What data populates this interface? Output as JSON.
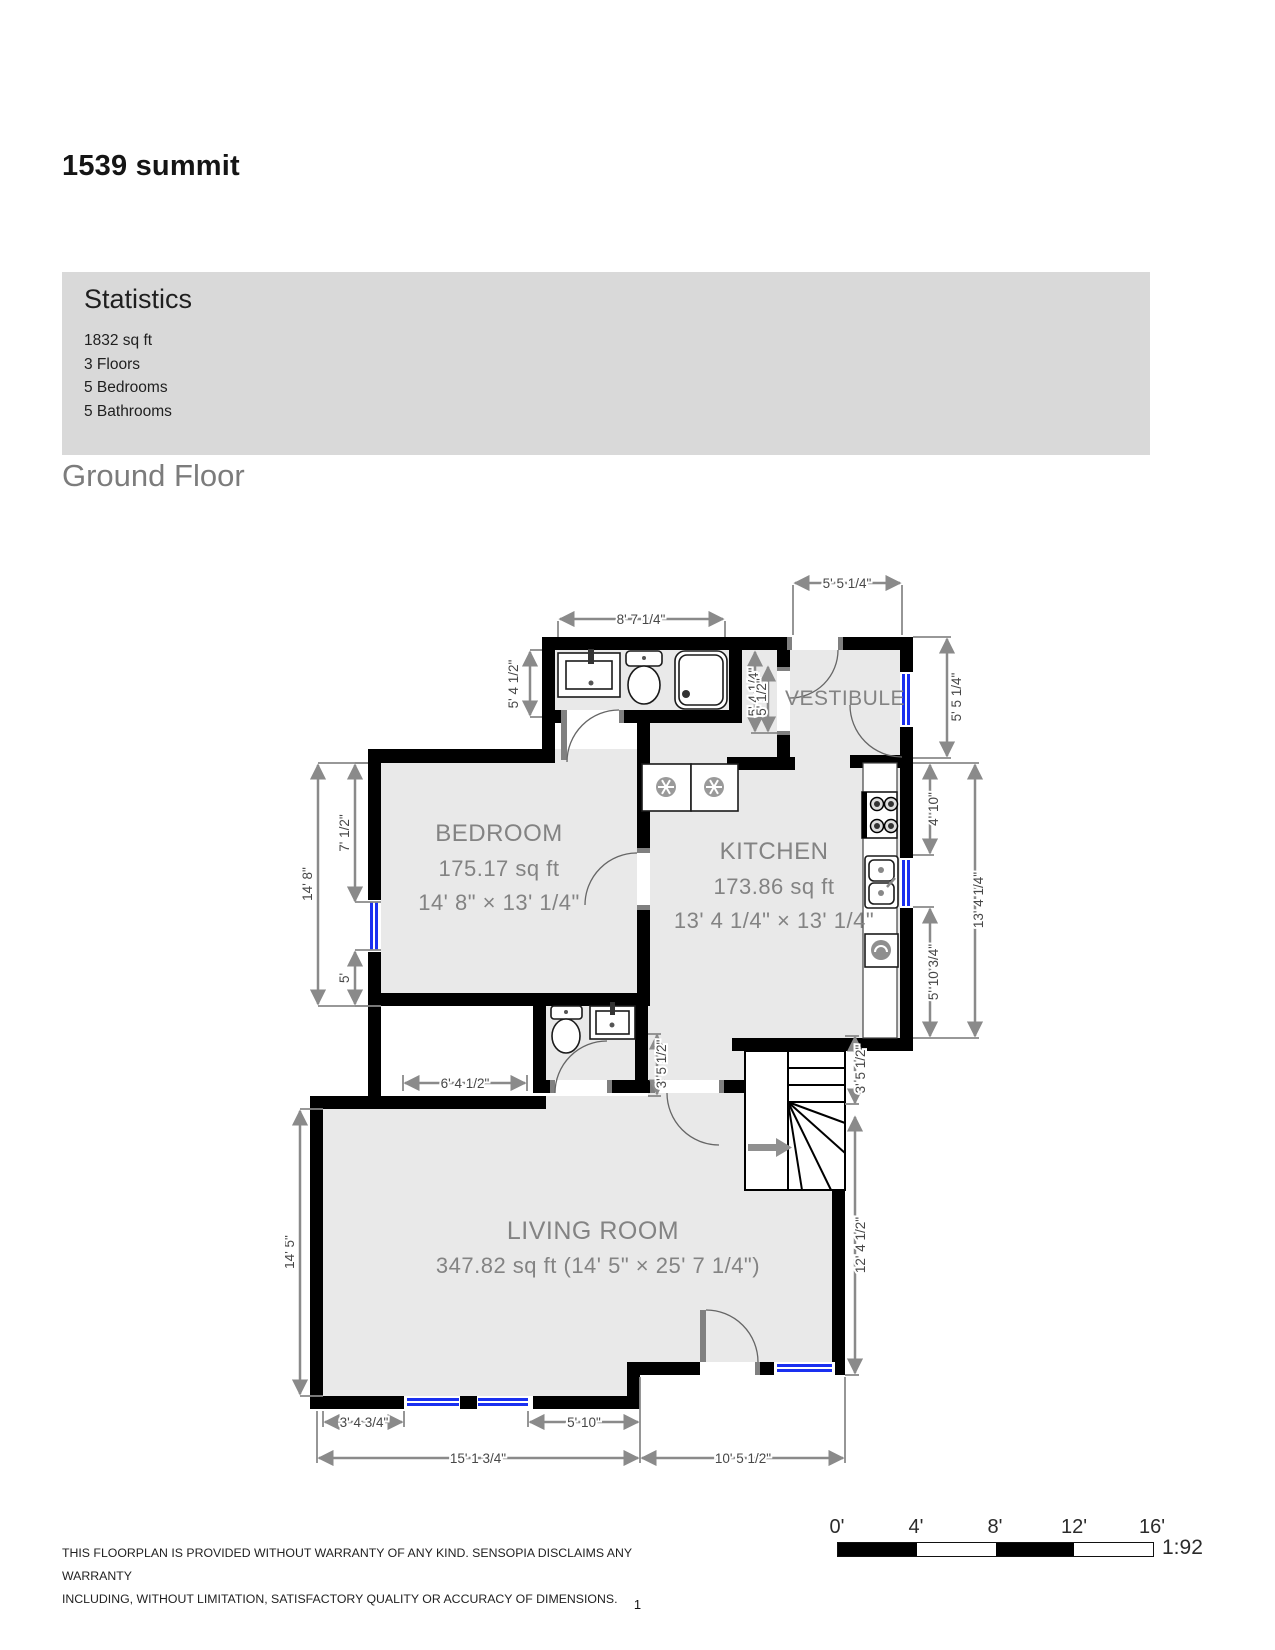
{
  "page": {
    "title": "1539 summit",
    "page_number": "1"
  },
  "statistics": {
    "heading": "Statistics",
    "items": [
      "1832 sq ft",
      "3 Floors",
      "5 Bedrooms",
      "5 Bathrooms"
    ]
  },
  "section": {
    "heading": "Ground Floor"
  },
  "floorplan": {
    "rooms": {
      "vestibule": {
        "name": "VESTIBULE"
      },
      "bedroom": {
        "name": "BEDROOM",
        "line2": "175.17 sq ft",
        "line3": "14' 8\" × 13' 1/4\""
      },
      "kitchen": {
        "name": "KITCHEN",
        "line2": "173.86 sq ft",
        "line3": "13' 4 1/4\" × 13' 1/4\""
      },
      "living": {
        "name": "LIVING ROOM",
        "line2": "347.82 sq ft (14' 5\" × 25' 7 1/4\")"
      }
    },
    "dims": {
      "bath_top": "8' 7 1/4\"",
      "vest_top": "5' 5 1/4\"",
      "vest_right": "5' 5 1/4\"",
      "bath_left": "5' 4 1/2\"",
      "hall_overlap_a": "5' 4 1/4\"",
      "hall_overlap_b": "5' 1/2\"",
      "kitchen_right_top": "4' 10\"",
      "kitchen_right_full": "13' 4 1/4\"",
      "kitchen_right_bottom": "5' 10 3/4\"",
      "bedroom_left_top": "7' 1/2\"",
      "bedroom_left_full": "14' 8\"",
      "bedroom_left_bottom": "5'",
      "closet": "6' 4 1/2\"",
      "hall_left": "3' 5 1/2\"",
      "hall_right": "3' 5 1/2\"",
      "living_left": "14' 5\"",
      "living_right": "12' 4 1/2\"",
      "window_offset": "3' 4 3/4\"",
      "window_mid": "5' 10\"",
      "bottom_left_total": "15' 1 3/4\"",
      "bottom_right_total": "10' 5 1/2\""
    },
    "colors": {
      "wall_black": "#000000",
      "floor_gray": "#e9e9e9",
      "window_blue": "#1a30f0",
      "dim_gray": "#8a8a8a",
      "stats_bg": "#d9d9d9"
    }
  },
  "scale_bar": {
    "ticks": [
      "0'",
      "4'",
      "8'",
      "12'",
      "16'"
    ],
    "ratio": "1:92"
  },
  "disclaimer": {
    "lines": [
      "THIS FLOORPLAN IS PROVIDED WITHOUT WARRANTY OF ANY KIND. SENSOPIA DISCLAIMS ANY WARRANTY",
      "INCLUDING, WITHOUT LIMITATION, SATISFACTORY QUALITY OR ACCURACY OF DIMENSIONS."
    ]
  }
}
